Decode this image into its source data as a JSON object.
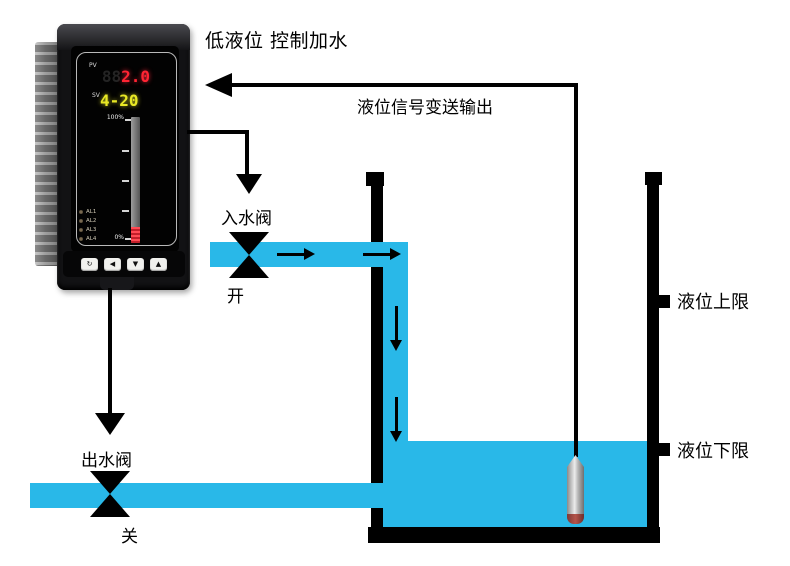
{
  "labels": {
    "top_note": "低液位 控制加水",
    "signal_output": "液位信号变送输出",
    "inlet_valve": "入水阀",
    "inlet_valve_state": "开",
    "outlet_valve": "出水阀",
    "outlet_valve_state": "关",
    "upper_limit": "液位上限",
    "lower_limit": "液位下限"
  },
  "controller": {
    "pv_label": "PV",
    "pv_ghost": "88",
    "pv_value": "2.0",
    "sv_label": "SV",
    "sv_value": "4-20",
    "bargraph": {
      "top_label": "100%",
      "bottom_label": "0%",
      "fill_percent": 13
    },
    "alarm_leds": [
      "AL1",
      "AL2",
      "AL3",
      "AL4"
    ],
    "buttons": [
      {
        "name": "loop-key",
        "glyph": "↻"
      },
      {
        "name": "shift-key",
        "glyph": "◀"
      },
      {
        "name": "down-key",
        "glyph": "▼"
      },
      {
        "name": "up-key",
        "glyph": "▲"
      }
    ]
  },
  "colors": {
    "water": "#29b8e8",
    "pv_digits": "#ff2433",
    "sv_digits": "#e8e825",
    "bar_fill": "#e0313c",
    "line": "#000000"
  }
}
